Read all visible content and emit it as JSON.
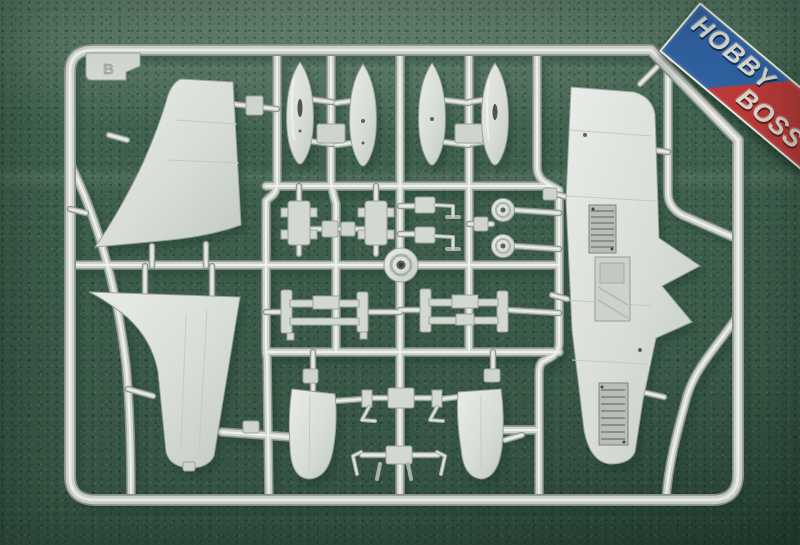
{
  "image": {
    "description": "Photograph of a Hobby Boss plastic model kit sprue: light grey injection-moulded aircraft parts on a runner frame, lying on dark green felt",
    "width_px": 800,
    "height_px": 545
  },
  "logo": {
    "top_word": "HOBBY",
    "bottom_word": "BOSS",
    "colors": {
      "blue": "#30609f",
      "red": "#bb3a3a",
      "border": "#e9e9df",
      "letters": "#dad9cd"
    }
  },
  "sprue": {
    "gate_tag": "B",
    "plastic_color": "#ced3cd",
    "plastic_highlight": "#eef0ec",
    "plastic_shadow": "#8b948c",
    "part_outline": "#98a199",
    "wheel_well_detail_color": "#6b726b"
  },
  "background": {
    "felt_color": "#4a6d59",
    "vignette_color": "#1f3a2b"
  },
  "parts": [
    {
      "name": "vertical-stabilizer-half",
      "count": 1
    },
    {
      "name": "drop-tank-half",
      "count": 4
    },
    {
      "name": "wing-lower-half",
      "count": 1
    },
    {
      "name": "lower-fin-half",
      "count": 1
    },
    {
      "name": "pylon",
      "count": 2
    },
    {
      "name": "l-shaped-bracket",
      "count": 2
    },
    {
      "name": "main-wheel",
      "count": 2
    },
    {
      "name": "wheel-hub",
      "count": 1
    },
    {
      "name": "equipment-rack",
      "count": 2
    },
    {
      "name": "landing-gear-door",
      "count": 2
    },
    {
      "name": "strut-assembly",
      "count": 2
    }
  ]
}
